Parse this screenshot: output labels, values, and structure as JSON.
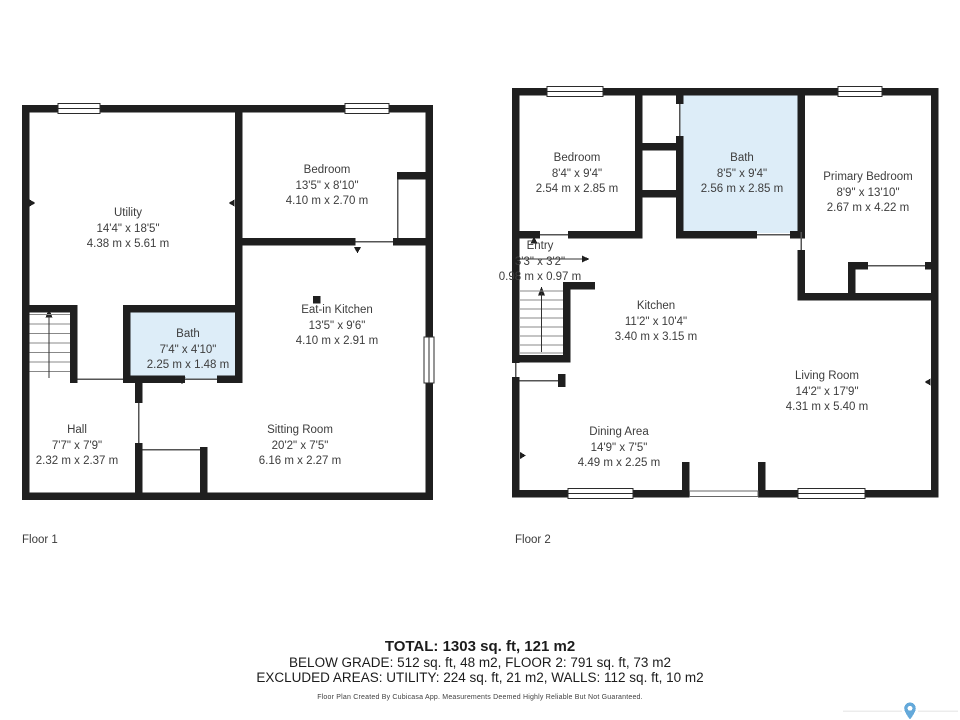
{
  "colors": {
    "wall": "#1f1f1f",
    "bath_fill": "#ddedf8",
    "pin_blue": "#64a9da"
  },
  "floors": [
    {
      "label": "Floor 1",
      "rooms": [
        {
          "id": "utility",
          "name": "Utility",
          "imperial": "14'4\" x 18'5\"",
          "metric": "4.38 m x 5.61 m"
        },
        {
          "id": "bedroom",
          "name": "Bedroom",
          "imperial": "13'5\" x 8'10\"",
          "metric": "4.10 m x 2.70 m"
        },
        {
          "id": "bath",
          "name": "Bath",
          "imperial": "7'4\" x 4'10\"",
          "metric": "2.25 m x 1.48 m"
        },
        {
          "id": "eat-in-kitchen",
          "name": "Eat-in Kitchen",
          "imperial": "13'5\" x 9'6\"",
          "metric": "4.10 m x 2.91 m"
        },
        {
          "id": "hall",
          "name": "Hall",
          "imperial": "7'7\" x 7'9\"",
          "metric": "2.32 m x 2.37 m"
        },
        {
          "id": "sitting-room",
          "name": "Sitting Room",
          "imperial": "20'2\" x 7'5\"",
          "metric": "6.16 m x 2.27 m"
        }
      ]
    },
    {
      "label": "Floor 2",
      "rooms": [
        {
          "id": "bedroom",
          "name": "Bedroom",
          "imperial": "8'4\" x 9'4\"",
          "metric": "2.54 m x 2.85 m"
        },
        {
          "id": "bath",
          "name": "Bath",
          "imperial": "8'5\" x 9'4\"",
          "metric": "2.56 m x 2.85 m"
        },
        {
          "id": "primary-bedroom",
          "name": "Primary Bedroom",
          "imperial": "8'9\" x 13'10\"",
          "metric": "2.67 m x 4.22 m"
        },
        {
          "id": "entry",
          "name": "Entry",
          "imperial": "3'3\" x 3'2\"",
          "metric": "0.98 m x 0.97 m"
        },
        {
          "id": "kitchen",
          "name": "Kitchen",
          "imperial": "11'2\" x 10'4\"",
          "metric": "3.40 m x 3.15 m"
        },
        {
          "id": "living-room",
          "name": "Living Room",
          "imperial": "14'2\" x 17'9\"",
          "metric": "4.31 m x 5.40 m"
        },
        {
          "id": "dining-area",
          "name": "Dining Area",
          "imperial": "14'9\" x 7'5\"",
          "metric": "4.49 m x 2.25 m"
        }
      ]
    }
  ],
  "summary": {
    "total": "TOTAL: 1303 sq. ft, 121 m2",
    "below_grade": "BELOW GRADE: 512 sq. ft, 48 m2, FLOOR 2: 791 sq. ft, 73 m2",
    "excluded": "EXCLUDED AREAS: UTILITY: 224 sq. ft, 21 m2, WALLS: 112 sq. ft, 10 m2"
  },
  "footer": {
    "disclaimer": "Floor Plan Created By Cubicasa App. Measurements Deemed Highly Reliable But Not Guaranteed."
  }
}
